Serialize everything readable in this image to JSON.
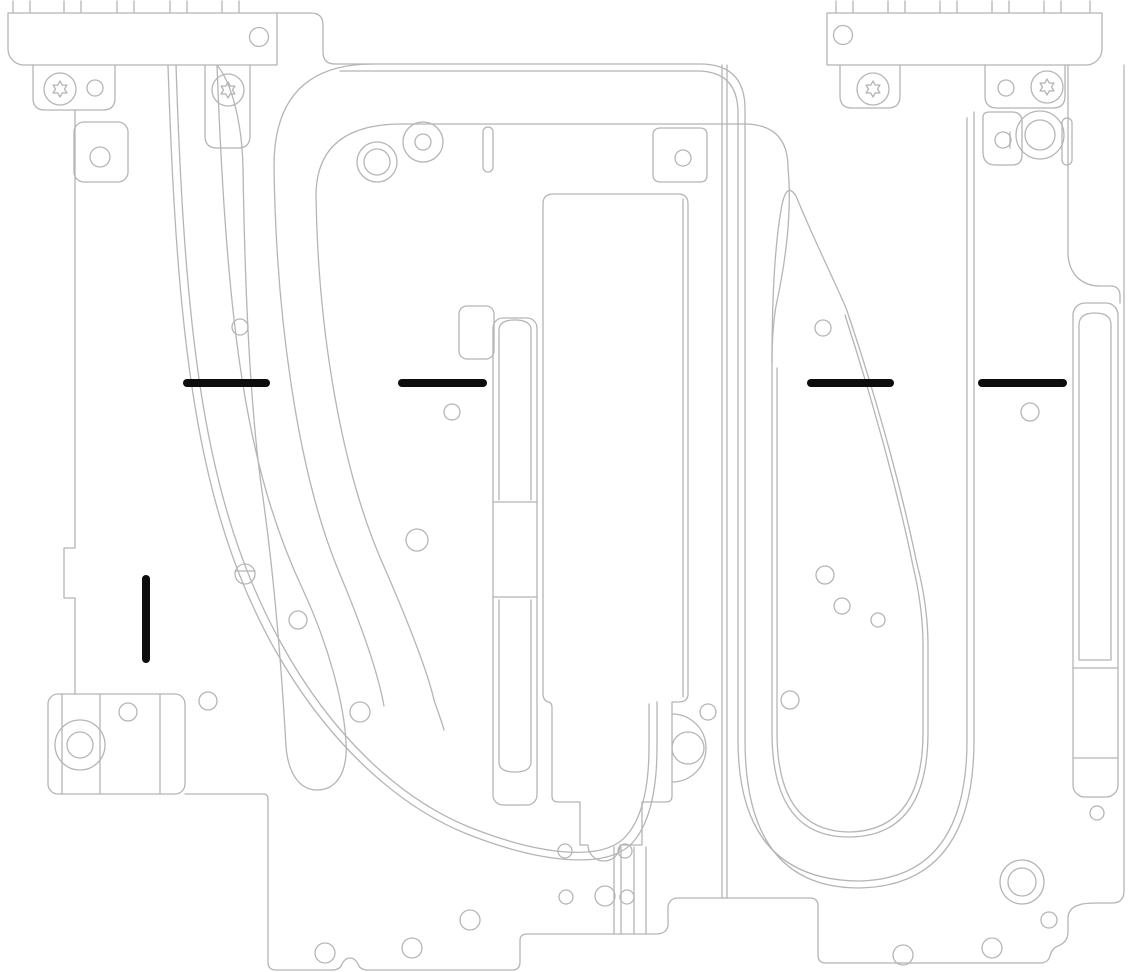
{
  "document": {
    "kind": "technical-line-illustration",
    "subject": "Liquid cooling cold plate assemblies with alignment ink marks",
    "background": "#ffffff"
  },
  "colors": {
    "outline": "#b5b5b5",
    "mark": "#0d0d0d"
  },
  "alignment_marks": {
    "horizontal": [
      {
        "x": 183,
        "y": 379,
        "w": 87,
        "h": 8
      },
      {
        "x": 398,
        "y": 379,
        "w": 89,
        "h": 8
      },
      {
        "x": 807,
        "y": 379,
        "w": 87,
        "h": 8
      },
      {
        "x": 978,
        "y": 379,
        "w": 89,
        "h": 8
      }
    ],
    "vertical": [
      {
        "x": 142,
        "y": 575,
        "w": 8,
        "h": 88
      }
    ]
  },
  "fasteners": {
    "torx_screws": [
      [
        60,
        89
      ],
      [
        228,
        90
      ],
      [
        873,
        89
      ],
      [
        1047,
        87
      ]
    ]
  },
  "holes": [
    [
      259,
      37,
      9.5
    ],
    [
      843,
      35,
      9.5
    ],
    [
      95,
      88,
      8
    ],
    [
      1006,
      88,
      8
    ],
    [
      100,
      157,
      10
    ],
    [
      683,
      158,
      8
    ],
    [
      1003,
      140,
      8
    ],
    [
      240,
      327,
      8
    ],
    [
      823,
      328,
      8
    ],
    [
      452,
      412,
      8
    ],
    [
      1030,
      412,
      9
    ],
    [
      417,
      540,
      11
    ],
    [
      245,
      574,
      10
    ],
    [
      298,
      620,
      9
    ],
    [
      825,
      575,
      9
    ],
    [
      842,
      606,
      8
    ],
    [
      878,
      620,
      7
    ],
    [
      128,
      712,
      9
    ],
    [
      208,
      701,
      9
    ],
    [
      360,
      712,
      10
    ],
    [
      790,
      700,
      9
    ],
    [
      708,
      712,
      8
    ],
    [
      688,
      748,
      16
    ],
    [
      1097,
      813,
      7
    ],
    [
      325,
      953,
      10
    ],
    [
      412,
      948,
      10
    ],
    [
      470,
      920,
      10
    ],
    [
      565,
      851,
      7
    ],
    [
      625,
      851,
      7
    ],
    [
      566,
      897,
      7
    ],
    [
      605,
      896,
      10
    ],
    [
      627,
      897,
      7
    ],
    [
      903,
      955,
      10
    ],
    [
      992,
      948,
      10
    ],
    [
      1049,
      920,
      8
    ]
  ],
  "ring_holes": [
    [
      377,
      162,
      20,
      13
    ],
    [
      423,
      142,
      20,
      8
    ],
    [
      80,
      745,
      25,
      13
    ],
    [
      1040,
      135,
      24,
      15
    ],
    [
      1022,
      882,
      22,
      14
    ]
  ],
  "connector_teeth": {
    "left_x": [
      13,
      30,
      64,
      81,
      117,
      134,
      170,
      187,
      222,
      239
    ],
    "right_x": [
      836,
      853,
      888,
      905,
      940,
      957,
      992,
      1009,
      1044,
      1061,
      1090
    ]
  }
}
